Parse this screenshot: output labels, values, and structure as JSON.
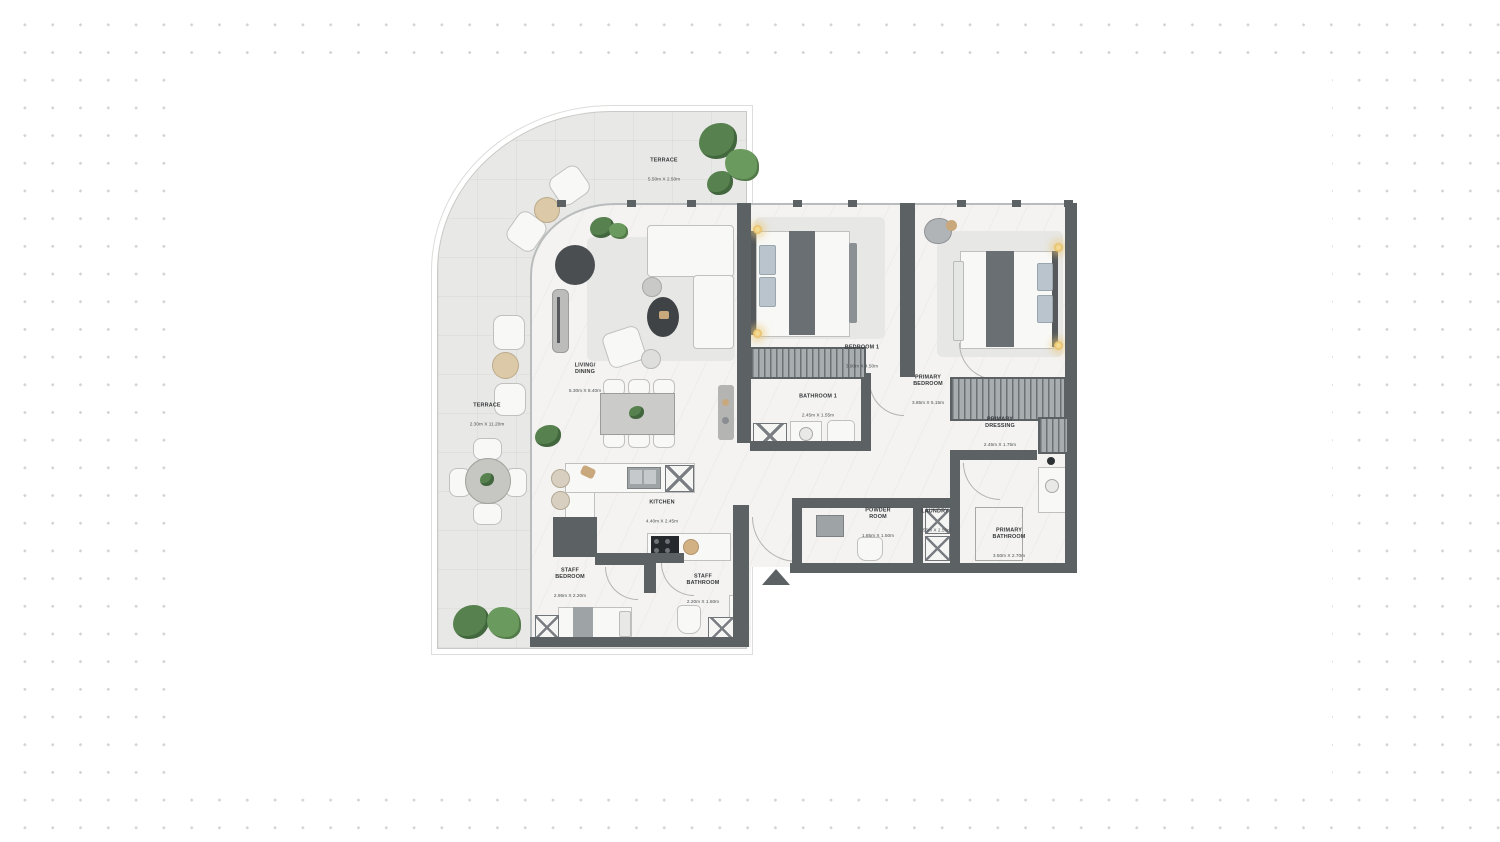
{
  "page": {
    "background_color": "#ffffff",
    "dot_color": "#d3d3d1",
    "panel_color": "#ffffff"
  },
  "plan": {
    "type": "apartment-floor-plan",
    "wall_color": "#5c6164",
    "floor_color": "#f4f3f1",
    "terrace_color": "#e8e8e6",
    "plant_color": "#57824f",
    "lamp_color": "#e9c878",
    "entrance_marker": "entry-arrow",
    "rooms": [
      {
        "id": "terrace-top",
        "name": "TERRACE",
        "dims": "5.50m X 2.50m"
      },
      {
        "id": "living-dining",
        "name": "LIVING/\nDINING",
        "dims": "5.30m X 8.40m"
      },
      {
        "id": "bedroom-1",
        "name": "BEDROOM 1",
        "dims": "3.90m X 4.50m"
      },
      {
        "id": "primary-bedroom",
        "name": "PRIMARY\nBEDROOM",
        "dims": "3.85m X 5.15m"
      },
      {
        "id": "bathroom-1",
        "name": "BATHROOM 1",
        "dims": "2.45m X 1.55m"
      },
      {
        "id": "primary-dressing",
        "name": "PRIMARY\nDRESSING",
        "dims": "2.45m X 1.75m"
      },
      {
        "id": "terrace-left",
        "name": "TERRACE",
        "dims": "2.30m X 11.20m"
      },
      {
        "id": "kitchen",
        "name": "KITCHEN",
        "dims": "4.40m X 2.45m"
      },
      {
        "id": "powder-room",
        "name": "POWDER\nROOM",
        "dims": "1.85m X 1.50m"
      },
      {
        "id": "laundry",
        "name": "LAUNDRY",
        "dims": "1.55m X 2.55m"
      },
      {
        "id": "primary-bathroom",
        "name": "PRIMARY\nBATHROOM",
        "dims": "3.50m X 2.70m"
      },
      {
        "id": "staff-bedroom",
        "name": "STAFF\nBEDROOM",
        "dims": "2.95m X 2.20m"
      },
      {
        "id": "staff-bathroom",
        "name": "STAFF\nBATHROOM",
        "dims": "2.20m X 1.60m"
      }
    ]
  }
}
